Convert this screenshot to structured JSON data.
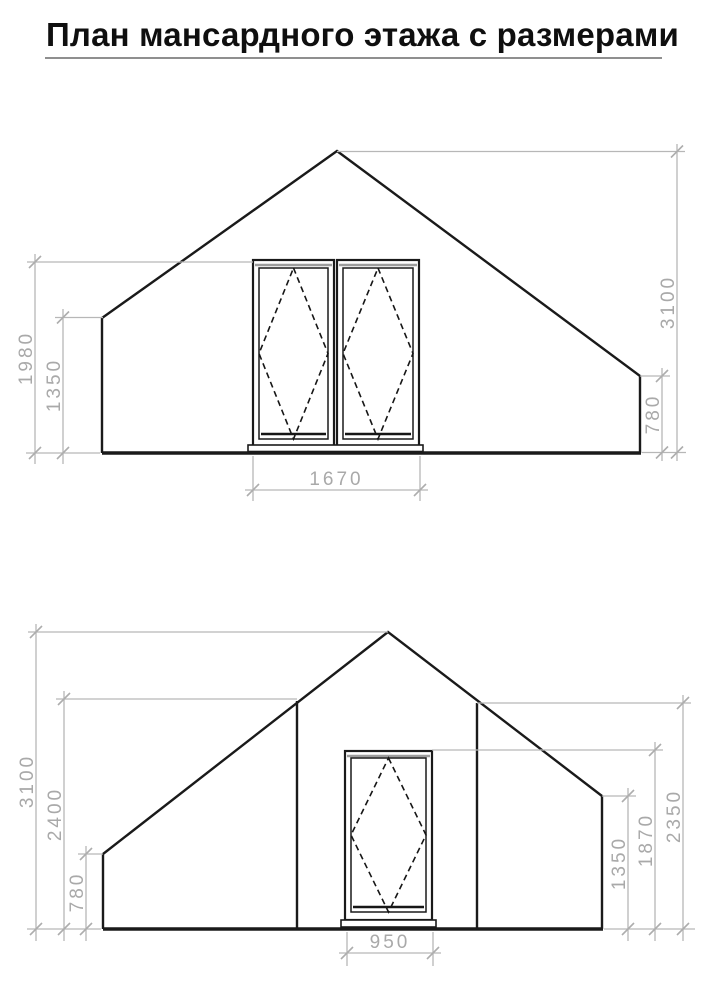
{
  "title": "План мансардного этажа с размерами",
  "colors": {
    "drawing_line": "#1a1a1a",
    "dimension_line": "#b7b7b7",
    "dimension_text": "#a9a9a9",
    "title_text": "#0f0f0f",
    "title_underline": "#8f8f8f",
    "background": "#ffffff"
  },
  "drawings": {
    "top": {
      "dims": {
        "left_outer": "1980",
        "left_inner": "1350",
        "right_outer": "3100",
        "right_inner": "780",
        "width": "1670"
      }
    },
    "bottom": {
      "dims": {
        "left_outer": "3100",
        "left_mid": "2400",
        "left_inner": "780",
        "right_inner": "1350",
        "right_mid": "1870",
        "right_outer": "2350",
        "width": "950"
      }
    }
  }
}
